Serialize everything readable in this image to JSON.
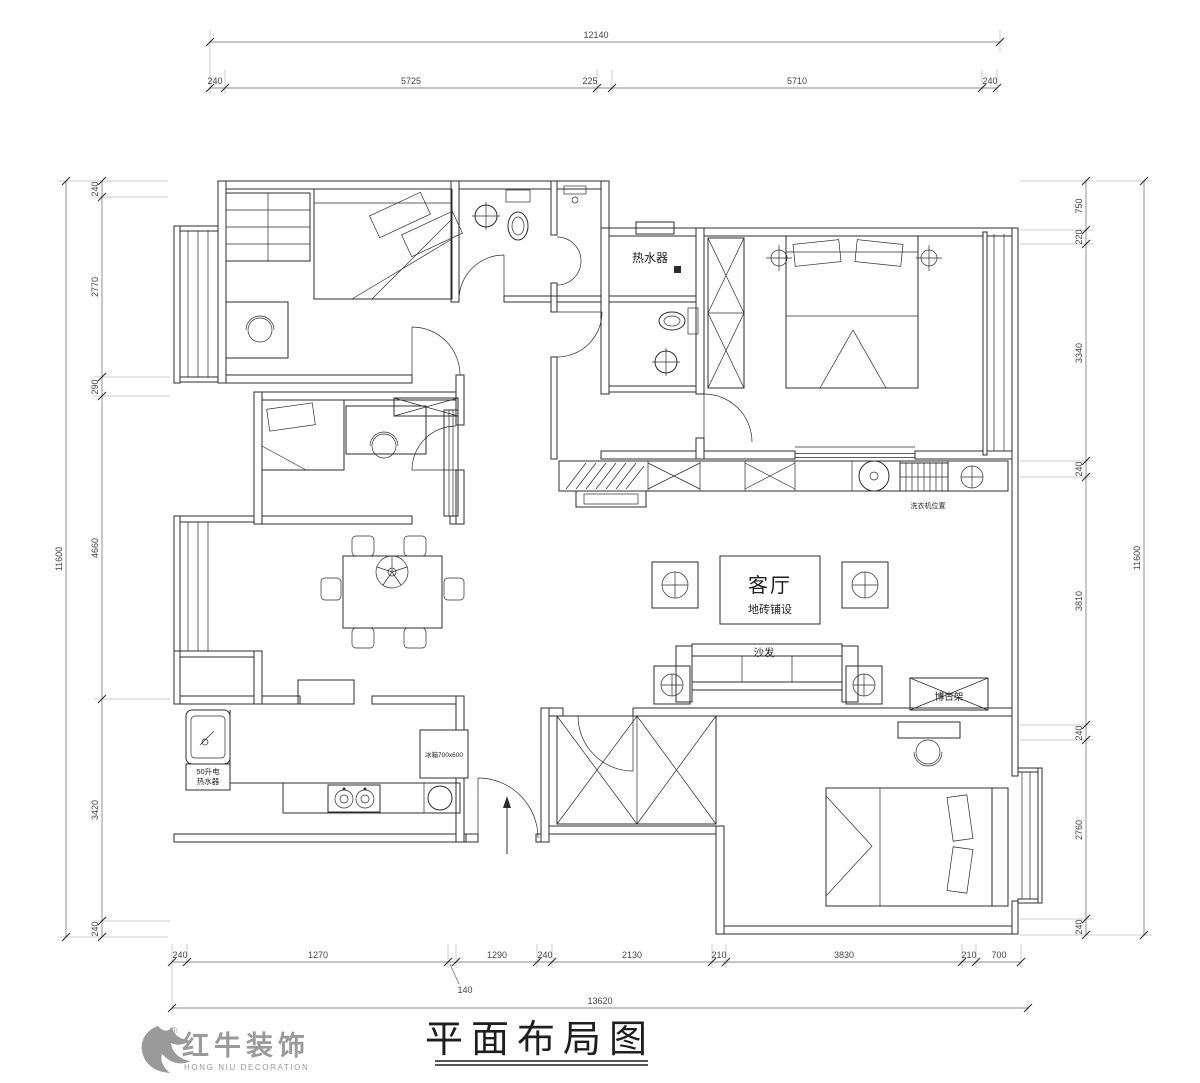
{
  "title_block": {
    "title": "平面布局图"
  },
  "logo": {
    "name": "红牛装饰",
    "sub": "HONG NIU DECORATION",
    "reg": "®"
  },
  "labels": {
    "living": "客厅",
    "living_sub": "地砖铺设",
    "water_heater": "热水器",
    "sofa": "沙发",
    "shelf": "博古架",
    "fridge": "冰箱700x600",
    "kitchen_heater_line1": "50升电",
    "kitchen_heater_line2": "热水器",
    "washer": "洗衣机位置"
  },
  "dims": {
    "top": {
      "total": "12140",
      "segments": [
        "240",
        "5725",
        "225",
        "5710",
        "240"
      ]
    },
    "bottom": {
      "total": "13620",
      "segments": [
        "240",
        "1270",
        "140",
        "1290",
        "240",
        "2130",
        "210",
        "3830",
        "210",
        "700"
      ]
    },
    "left": {
      "total": "11600",
      "segments": [
        "240",
        "2770",
        "290",
        "4660",
        "3420",
        "240"
      ]
    },
    "right": {
      "total": "11600",
      "segments": [
        "750",
        "220",
        "3340",
        "240",
        "3810",
        "240",
        "2760",
        "240"
      ]
    }
  },
  "colors": {
    "line": "#2d2d2d",
    "logo": "#9a9a9a",
    "bg": "#ffffff"
  }
}
